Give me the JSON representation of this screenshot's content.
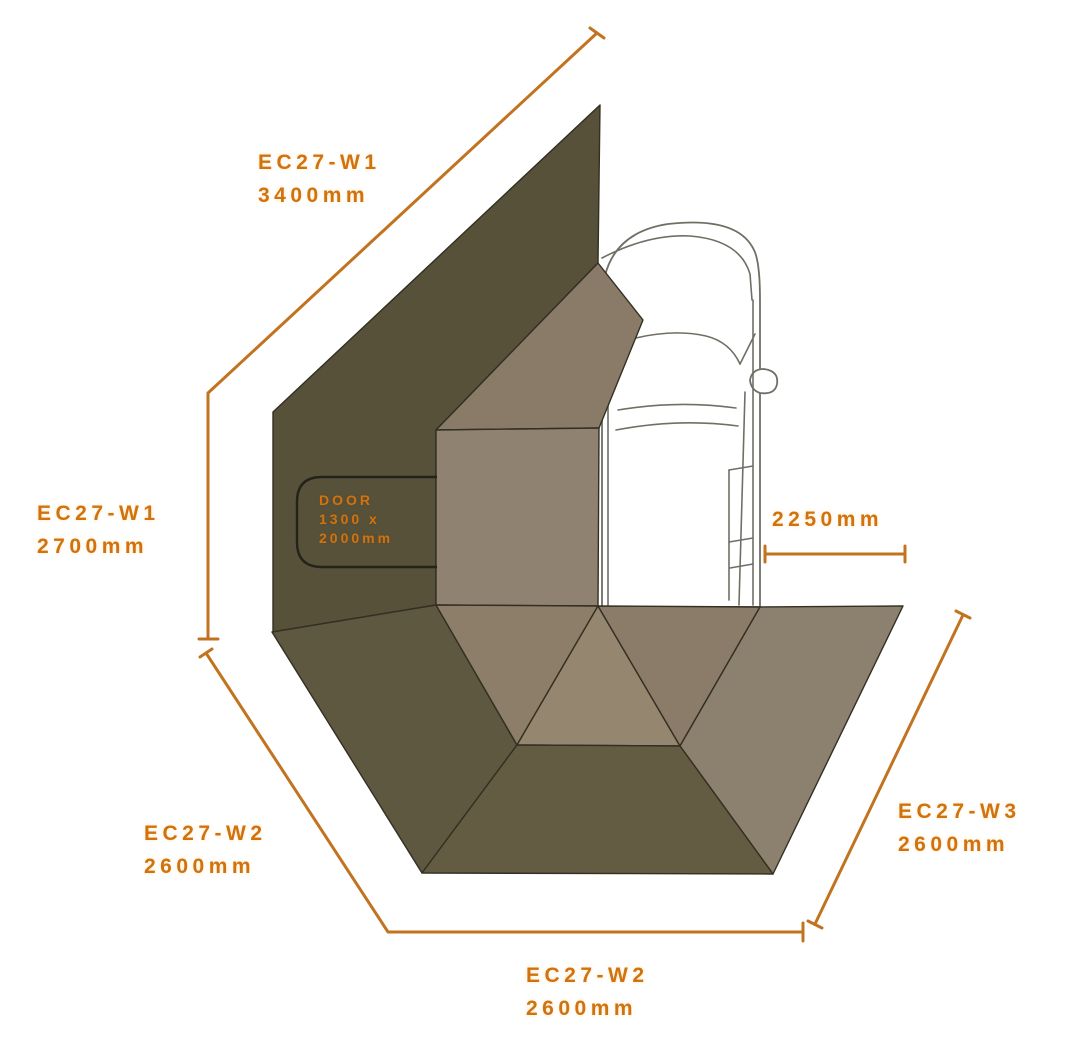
{
  "colors": {
    "background": "#FFFFFF",
    "label_orange": "#D2720E",
    "dimension_line": "#C2731F",
    "panel_stroke": "#332F22",
    "door_outline": "#23231A",
    "car_outline": "#6F6F66",
    "wall_dark": "#57513A",
    "roof_panel": "#8A7B68",
    "side_panel": "#908271",
    "fan_left_dark": "#5E5840",
    "fan_triangle_left": "#8C7E68",
    "fan_triangle_center": "#95876F",
    "fan_triangle_right": "#8A7C68",
    "fan_right_gray": "#8C806F",
    "fan_front_dark": "#635C42"
  },
  "labels": {
    "top": {
      "line1": "EC27-W1",
      "line2": "3400mm"
    },
    "left": {
      "line1": "EC27-W1",
      "line2": "2700mm"
    },
    "vehicle_offset": {
      "line1": "2250mm"
    },
    "bottom_left": {
      "line1": "EC27-W2",
      "line2": "2600mm"
    },
    "bottom_center": {
      "line1": "EC27-W2",
      "line2": "2600mm"
    },
    "bottom_right": {
      "line1": "EC27-W3",
      "line2": "2600mm"
    },
    "door": {
      "line1": "DOOR",
      "line2": "1300 x",
      "line3": "2000mm"
    }
  },
  "measurements": {
    "wall_w1_top_mm": 3400,
    "wall_w1_side_mm": 2700,
    "vehicle_offset_mm": 2250,
    "wall_w2_left_mm": 2600,
    "wall_w2_bottom_mm": 2600,
    "wall_w3_mm": 2600,
    "door_width_mm": 1300,
    "door_height_mm": 2000
  }
}
